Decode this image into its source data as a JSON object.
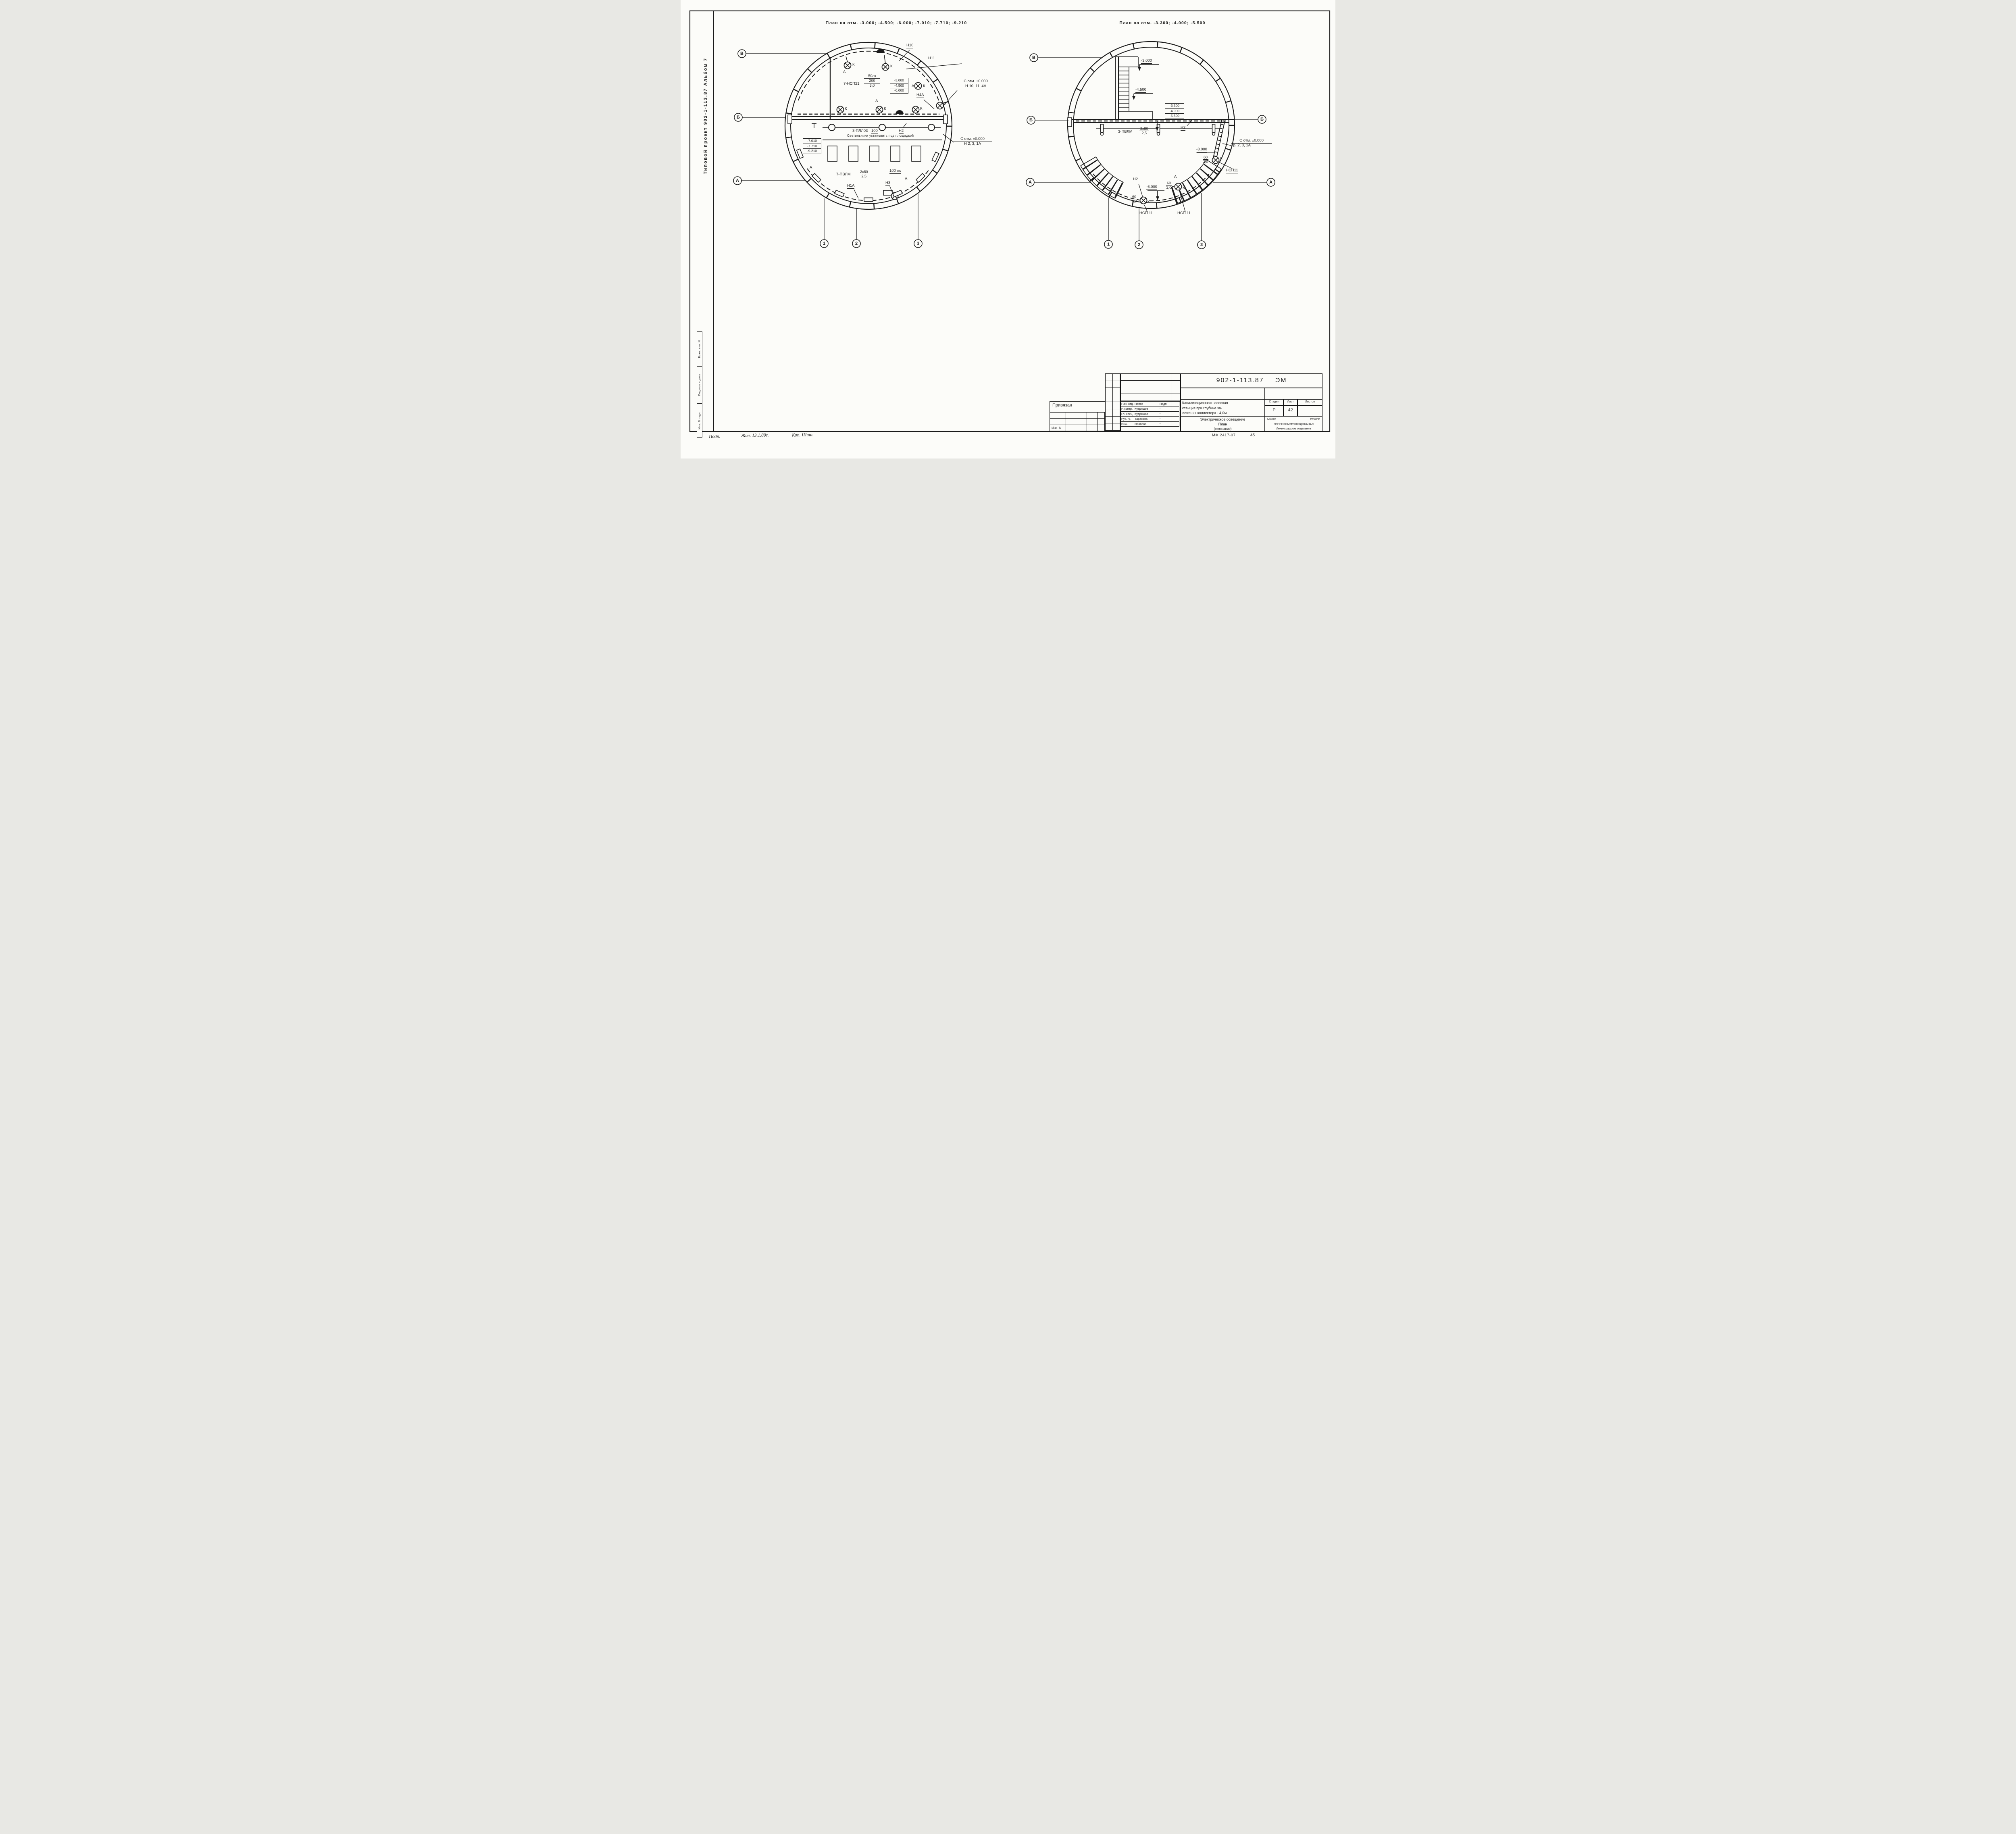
{
  "sidebar": {
    "title": "Типовой проект 902-1-113.87  Альбом 7"
  },
  "stamps": {
    "vzam": "Взам. инв. N",
    "podpis": "Подпись и дата",
    "inv_podl": "Инв. N подл."
  },
  "plans": {
    "left": {
      "title": "План на отм. -3.000; -4.500; -6.000; -7.010; -7.710; -9.210",
      "labels": {
        "n10": "Н10",
        "n11": "Н11",
        "n4a": "Н4А",
        "n2": "Н2",
        "n1a": "Н1А",
        "n3": "Н3"
      },
      "fixtures": {
        "nsp21": "7-НСП21",
        "nsp21_lux": "50лк",
        "nsp21_num": "200",
        "nsp21_den": "3,0",
        "pll": "3-ПЛЛ03",
        "pll_num": "100",
        "pvlm": "7-ПВЛМ",
        "pvlm_num": "2x80",
        "pvlm_den": "2,5",
        "pvlm_lux": "100 лк"
      },
      "notes": {
        "platform": "Светильники установить под площадкой",
        "otm1": "С отм. ±0.000",
        "otm1_sub": "Н 10, 11, 4А",
        "otm2": "С отм. ±0.000",
        "otm2_sub": "Н 2, 3, 1А"
      },
      "tables": {
        "upper": [
          "-3.000",
          "-4.500",
          "-6.000"
        ],
        "lower": [
          "-7.010",
          "-7.710",
          "-9.210"
        ]
      },
      "letters": {
        "k": "К",
        "a": "А"
      }
    },
    "right": {
      "title": "План на отм. -3.300; -4.000; -5.500",
      "levels": {
        "m3000": "-3.000",
        "m4500": "-4.500",
        "m6000": "-6.000",
        "m3000r": "-3.000"
      },
      "table": [
        "-3.300",
        "-4.000",
        "-5.500"
      ],
      "fixtures": {
        "pvlm": "3-ПВЛМ",
        "pvlm_num": "2x80",
        "pvlm_den": "2,5",
        "lamp_num": "60",
        "lamp_den": "2,0",
        "nsp11": "НСП11",
        "nsp11b": "НСП 11"
      },
      "labels": {
        "n2": "Н2"
      },
      "notes": {
        "otm": "С отм. ±0.000",
        "otm_sub": "Гр. 2, 3, 1А"
      },
      "letters": {
        "k": "К",
        "a": "А"
      }
    }
  },
  "axes": {
    "v": "В",
    "b": "Б",
    "a": "А",
    "n1": "1",
    "n2": "2",
    "n3": "3"
  },
  "titleblock": {
    "doc_number": "902-1-113.87",
    "doc_code": "ЭМ",
    "privyazan": "Привязан",
    "inv_n": "Инв. N",
    "staff": [
      {
        "role": "Нач. отд.",
        "name": "Попов",
        "sign": "Подп."
      },
      {
        "role": "Н.контр.",
        "name": "Кудряшов",
        "sign": "″"
      },
      {
        "role": "Гл. спец.",
        "name": "Кудряшов",
        "sign": "″"
      },
      {
        "role": "Рук. гр.",
        "name": "Тарасова",
        "sign": "″"
      },
      {
        "role": "Инж.",
        "name": "Осипова",
        "sign": "″"
      }
    ],
    "object_lines": [
      "Канализационная насосная",
      "станция при глубине за-",
      "ложения коллектора - 4,0м"
    ],
    "stage_headers": [
      "Стадия",
      "Лист",
      "Листов"
    ],
    "stage_values": [
      "Р",
      "42",
      ""
    ],
    "sheet_lines": [
      "Электрическое освещение",
      "План",
      "(окончание)"
    ],
    "org": {
      "top_left": "МЖКХ",
      "top_right": "РСФСР",
      "mid": "ГИПРОКОММУНВОДОКАНАЛ",
      "bot": "Ленинградское отделение"
    },
    "mf": "МФ 2417-07",
    "sheet_no": "45"
  },
  "handwriting": {
    "left": "Подп.",
    "mid": "Жил. 13.1.89г.",
    "right": "Коп. Шиш."
  }
}
